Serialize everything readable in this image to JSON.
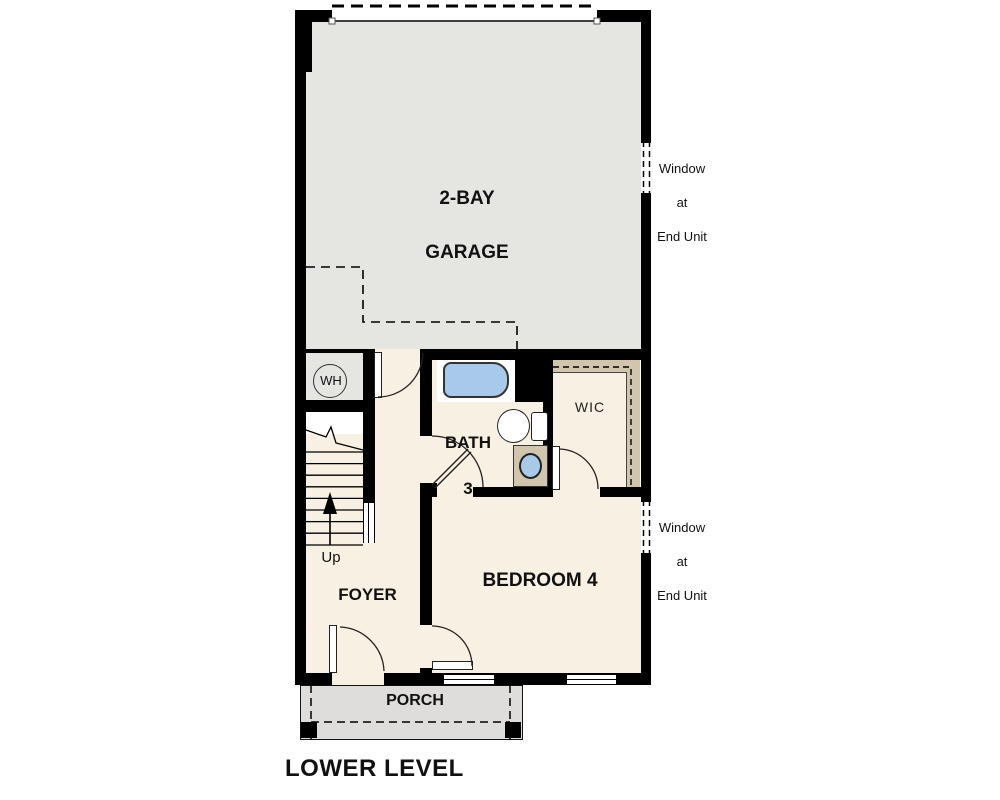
{
  "title": "LOWER LEVEL",
  "colors": {
    "wall": "#000000",
    "garage_floor": "#e5e5e2",
    "room_floor": "#f8f0e2",
    "closet_tan": "#d2c5ae",
    "porch_gray": "#dedddb",
    "fixture_blue": "#a9c9ea"
  },
  "rooms": {
    "garage": {
      "line1": "2-BAY",
      "line2": "GARAGE"
    },
    "bath": {
      "line1": "BATH",
      "line2": "3"
    },
    "wic": {
      "label": "WIC"
    },
    "bedroom": {
      "label": "BEDROOM 4"
    },
    "foyer": {
      "label": "FOYER"
    },
    "porch": {
      "label": "PORCH"
    }
  },
  "markers": {
    "water_heater": "WH",
    "stairs_up": "Up"
  },
  "annotations": {
    "window_top": {
      "line1": "Window",
      "line2": "at",
      "line3": "End Unit"
    },
    "window_bottom": {
      "line1": "Window",
      "line2": "at",
      "line3": "End Unit"
    }
  }
}
